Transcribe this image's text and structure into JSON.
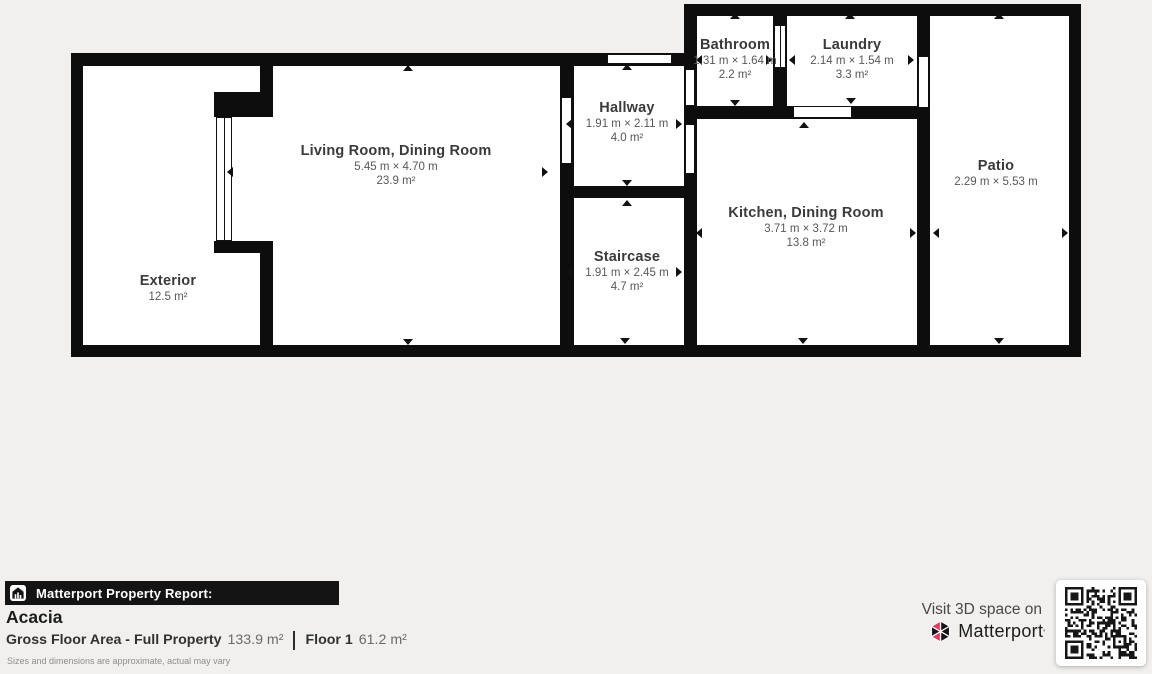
{
  "colors": {
    "background": "#f1f0ee",
    "wall": "#0d0d0d",
    "room_fill": "#ffffff",
    "accent_pink": "#e93963",
    "report_bar_bg": "#141414"
  },
  "floorplan": {
    "rooms": [
      {
        "name": "Exterior",
        "area": "12.5 m²"
      },
      {
        "name": "Living Room, Dining Room",
        "dims": "5.45 m × 4.70 m",
        "area": "23.9 m²"
      },
      {
        "name": "Hallway",
        "dims": "1.91 m × 2.11 m",
        "area": "4.0 m²"
      },
      {
        "name": "Staircase",
        "dims": "1.91 m × 2.45 m",
        "area": "4.7 m²"
      },
      {
        "name": "Bathroom",
        "dims": "1.31 m × 1.64 m",
        "area": "2.2 m²"
      },
      {
        "name": "Laundry",
        "dims": "2.14 m × 1.54 m",
        "area": "3.3 m²"
      },
      {
        "name": "Kitchen, Dining Room",
        "dims": "3.71 m × 3.72 m",
        "area": "13.8 m²"
      },
      {
        "name": "Patio",
        "dims": "2.29 m × 5.53 m"
      }
    ]
  },
  "report": {
    "header": "Matterport Property Report:",
    "property_name": "Acacia",
    "gfa_label": "Gross Floor Area - Full Property",
    "gfa_value": "133.9 m²",
    "floor_label": "Floor 1",
    "floor_value": "61.2 m²",
    "disclaimer": "Sizes and dimensions are approximate, actual may vary"
  },
  "cta": {
    "visit_label": "Visit 3D space on",
    "brand": "Matterport",
    "brand_mark": "'"
  }
}
